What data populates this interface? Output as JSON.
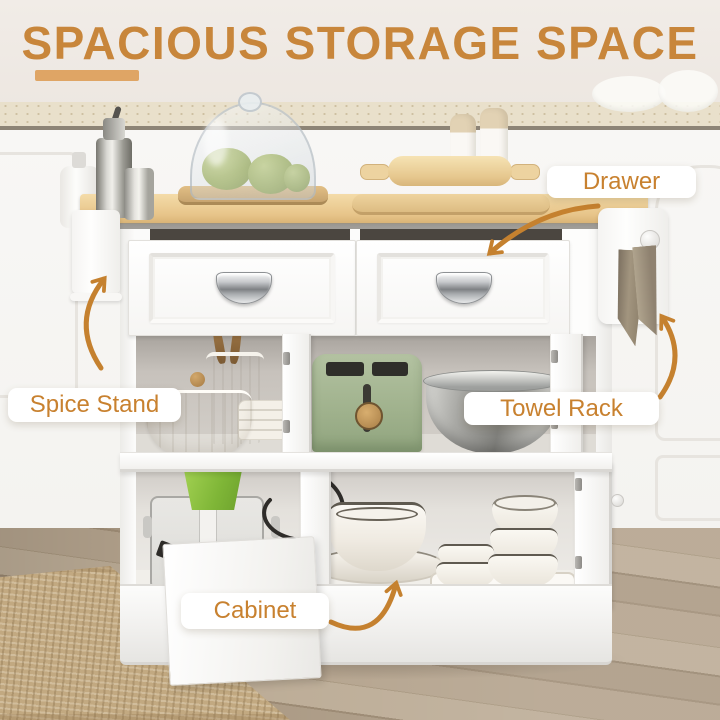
{
  "title": {
    "text": "SPACIOUS STORAGE SPACE"
  },
  "callouts": {
    "drawer": "Drawer",
    "spice_stand": "Spice Stand",
    "towel_rack": "Towel Rack",
    "cabinet": "Cabinet"
  },
  "colors": {
    "accent_title": "#C8863B",
    "accent_underline": "#DFA565",
    "callout_text": "#C8812F",
    "arrow": "#C5812F",
    "pill_background": "#FFFFFF"
  },
  "scene": {
    "items": [
      "glass-cloche-with-fruit",
      "wooden-tray",
      "oil-dispenser-bottles",
      "soap-dispenser",
      "rolling-pin",
      "cutting-board",
      "salt-pepper-shakers",
      "wood-cart-top",
      "two-drawers",
      "cup-handles",
      "utensil-crock",
      "wooden-spoons",
      "fluted-bowl",
      "plate-stack",
      "green-toaster",
      "stainless-pot",
      "food-processor",
      "serving-bowl-and-plate",
      "bowl-stack",
      "small-bowls",
      "serving-trays",
      "spice-stand-panel",
      "towel-rack-with-towel",
      "jute-rug",
      "wood-floor"
    ]
  }
}
